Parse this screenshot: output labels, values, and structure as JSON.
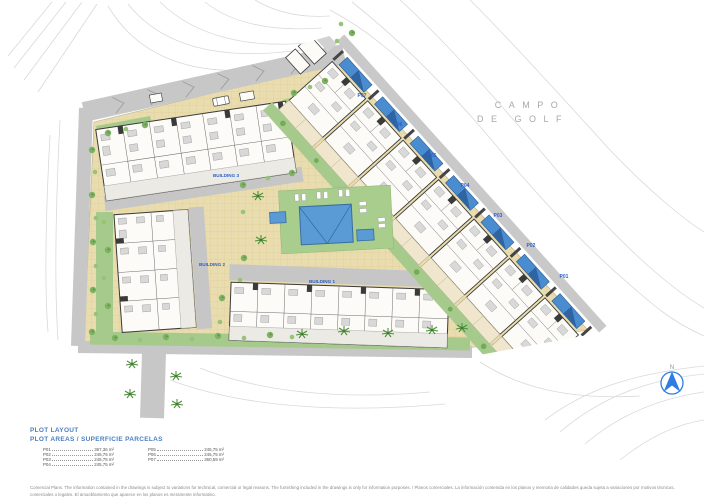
{
  "plan": {
    "golf_label": {
      "line1": "CAMPO",
      "line2": "DE GOLF"
    },
    "compass_label": "N",
    "buildings": [
      {
        "label": "BUILDING 3"
      },
      {
        "label": "BUILDING 2"
      },
      {
        "label": "BUILDING 1"
      }
    ],
    "plots": [
      {
        "id": "P07"
      },
      {
        "id": "P06"
      },
      {
        "id": "P05"
      },
      {
        "id": "P04"
      },
      {
        "id": "P03"
      },
      {
        "id": "P02"
      },
      {
        "id": "P01"
      }
    ]
  },
  "legend": {
    "title": "PLOT LAYOUT",
    "subtitle": "PLOT AREAS / SUPERFICIE PARCELAS",
    "areas": [
      {
        "plot": "P01",
        "area": "367,36 m²"
      },
      {
        "plot": "P02",
        "area": "245,75 m²"
      },
      {
        "plot": "P03",
        "area": "245,75 m²"
      },
      {
        "plot": "P04",
        "area": "245,75 m²"
      },
      {
        "plot": "P05",
        "area": "245,75 m²"
      },
      {
        "plot": "P06",
        "area": "245,75 m²"
      },
      {
        "plot": "P07",
        "area": "360,59 m²"
      }
    ]
  },
  "footer": {
    "disclaimer": "Comercial Plans. The information contained in the drawings is subject to variations for technical, comercial or legal reasons. The furnishing included in the drawings is only for information purposes. / Planos comerciales. La información contenida en los planos y memoria de calidades queda sujeta a variaciones por motivos técnicos, comerciales o legales. El amueblamiento que aparece en los planos es meramente informativo."
  },
  "colors": {
    "accent_blue": "#2e5fc7",
    "legend_blue": "#4a7fc0",
    "pool_blue": "#5b9bd5",
    "villa_pool_blue": "#4a8cd0",
    "lawn_green": "#a8cc8b",
    "paving_tan": "#e9dcae",
    "road_gray": "#c7c7c7"
  }
}
